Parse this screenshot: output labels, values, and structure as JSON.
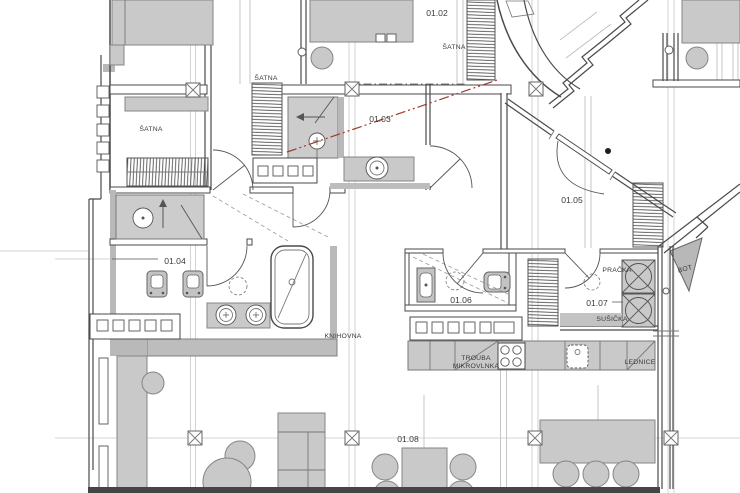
{
  "page": {
    "title": "Apartment floor plan"
  },
  "colors": {
    "wall": "#4a4a4a",
    "furniture_fill": "#c9c9c9",
    "furniture_stroke": "#858585",
    "floor_fill": "#cccccc",
    "grid": "#c9c9c9",
    "section_line": "#9e392f",
    "label": "#3a3a3a",
    "bottom_band": "#454545"
  },
  "rooms": {
    "r0102": "01.02",
    "r0103": "01.03",
    "r0104": "01.04",
    "r0105": "01.05",
    "r0106": "01.06",
    "r0107": "01.07",
    "r0108": "01.08"
  },
  "fixtures": {
    "wardrobe_left": "ŠATNA",
    "wardrobe_mid": "ŠATNA",
    "wardrobe_top": "ŠATNA",
    "bookshelf": "KNIHOVNA",
    "oven_line1": "TROUBA",
    "oven_line2": "MIKROVLNKA",
    "fridge": "LEDNICE",
    "washing_machine": "PRAČKA",
    "dryer": "SUŠIČKA",
    "shoe_rack": "BOT"
  }
}
